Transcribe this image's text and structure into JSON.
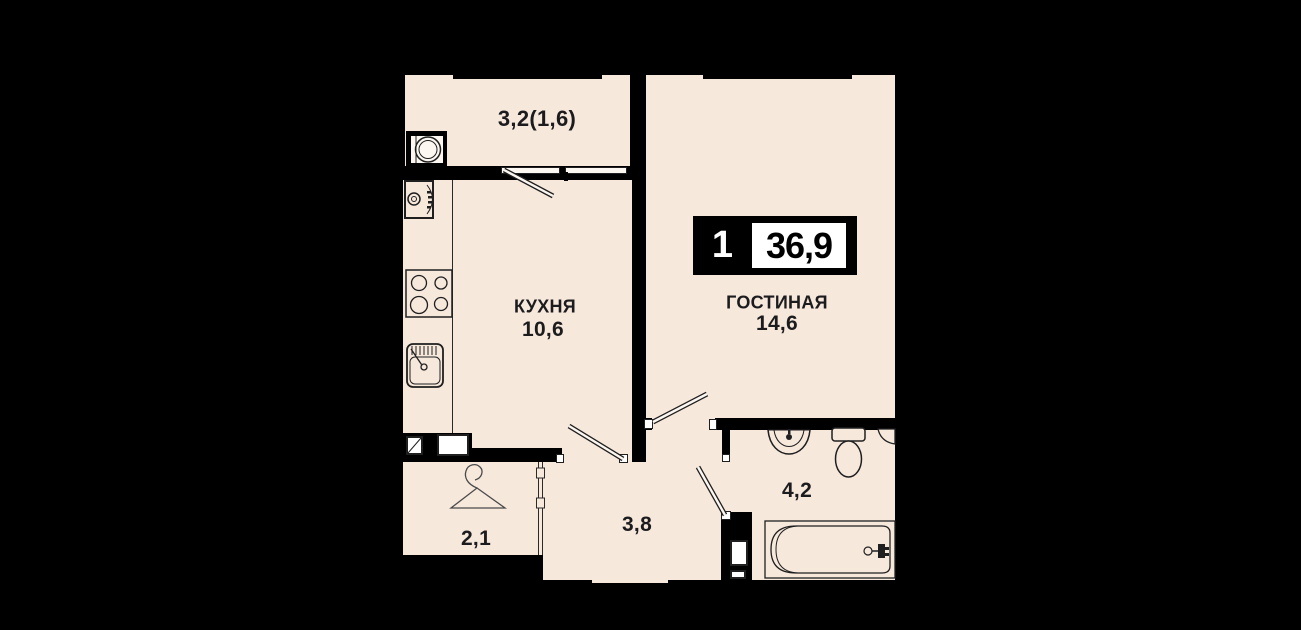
{
  "plan": {
    "title": "apartment floor plan",
    "badge": {
      "rooms_count": "1",
      "total_area": "36,9"
    },
    "rooms": {
      "balcony": {
        "label": "3,2(1,6)"
      },
      "kitchen": {
        "name": "КУХНЯ",
        "area": "10,6"
      },
      "living": {
        "name": "ГОСТИНАЯ",
        "area": "14,6"
      },
      "hall": {
        "area": "2,1"
      },
      "corridor": {
        "area": "3,8"
      },
      "bathroom": {
        "area": "4,2"
      }
    },
    "colors": {
      "background": "#000000",
      "floor": "#f7e8dc",
      "wall": "#000000",
      "outline": "#1f1f1f",
      "badge_bg": "#000000",
      "badge_box": "#ffffff",
      "text": "#1c1c1e"
    },
    "icons": [
      "washing-machine-icon",
      "oven-icon",
      "stove-icon",
      "kitchen-sink-icon",
      "hanger-icon",
      "bath-sink-icon",
      "toilet-icon",
      "bathtub-icon",
      "vent-shaft-icon"
    ]
  }
}
